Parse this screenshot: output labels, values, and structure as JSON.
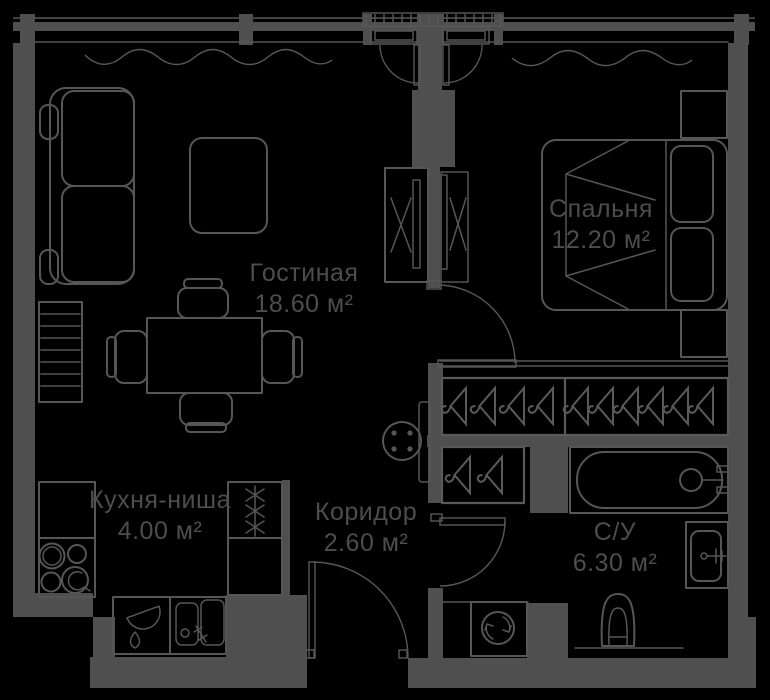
{
  "plan": {
    "type": "apartment-floor-plan",
    "colors": {
      "background": "#000000",
      "walls": "#4f4f4f",
      "furniture_lines": "#565656",
      "text": "#4d4d4d"
    }
  },
  "rooms": [
    {
      "name": "Гостиная",
      "area": "18.60 м²"
    },
    {
      "name": "Спальня",
      "area": "12.20 м²"
    },
    {
      "name": "Кухня-ниша",
      "area": "4.00 м²"
    },
    {
      "name": "Коридор",
      "area": "2.60 м²"
    },
    {
      "name": "С/У",
      "area": "6.30 м²"
    }
  ],
  "symbols": [
    "sofa-icon",
    "coffee-table-icon",
    "dining-table-icon",
    "chair-icon",
    "radiator-icon",
    "sliding-wardrobe-icon",
    "round-stool-icon",
    "double-bed-icon",
    "pillow-icon",
    "nightstand-icon",
    "hanger-closet-icon",
    "bathtub-icon",
    "wash-basin-icon",
    "toilet-icon",
    "washing-machine-icon",
    "kitchen-counter-icon",
    "stove-burners-icon",
    "refrigerator-icon",
    "kitchen-sink-icon",
    "window-icon",
    "curtain-wave-icon",
    "door-swing-icon"
  ]
}
